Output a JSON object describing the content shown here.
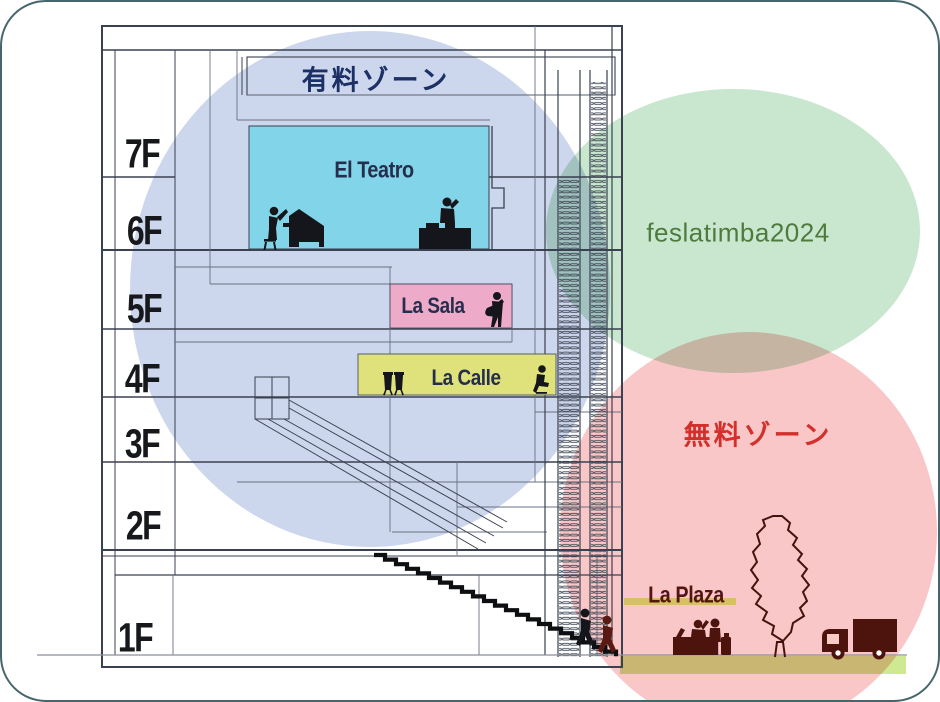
{
  "slide": {
    "background": "#ffffff",
    "frame_border_color": "#46656c"
  },
  "zones": {
    "paid": {
      "label": "有料ゾーン",
      "text_color": "#1d3066",
      "circle_color": "#ccd6ec"
    },
    "event": {
      "label": "feslatimba2024",
      "text_color": "#4e7b3d",
      "circle_color": "#c9e7cf"
    },
    "free": {
      "label": "無料ゾーン",
      "text_color": "#d3302c",
      "circle_color": "#f9c7c7"
    }
  },
  "venues": {
    "teatro": {
      "label": "El Teatro",
      "box_color": "#82d4e8",
      "text_color": "#262e4e"
    },
    "sala": {
      "label": "La Sala",
      "box_color": "#edaac9",
      "text_color": "#262e4e"
    },
    "calle": {
      "label": "La Calle",
      "box_color": "#dfe17a",
      "text_color": "#262e4e"
    },
    "plaza": {
      "label": "La Plaza",
      "text_color": "#53150f",
      "bar_color": "#d5c169"
    }
  },
  "floors": {
    "labels": [
      "7F",
      "6F",
      "5F",
      "4F",
      "3F",
      "2F",
      "1F"
    ],
    "text_color": "#16181b"
  },
  "ground": {
    "strip_color": "#cfe993",
    "line_color": "#8b909b"
  },
  "drawing": {
    "line_color": "#3a4150",
    "icon_color_black": "#14161c",
    "icon_color_maroon": "#4d140e"
  },
  "icons": [
    "pianist-icon",
    "grand-piano-icon",
    "dj-booth-icon",
    "guitarist-icon",
    "congas-icon",
    "seated-percussionist-icon",
    "escalator-icon",
    "stair-hatch",
    "grand-staircase",
    "stair-climber-icon",
    "reception-desk-icon",
    "standing-visitor-icon",
    "suitcase-icon",
    "tree-icon",
    "truck-icon"
  ]
}
